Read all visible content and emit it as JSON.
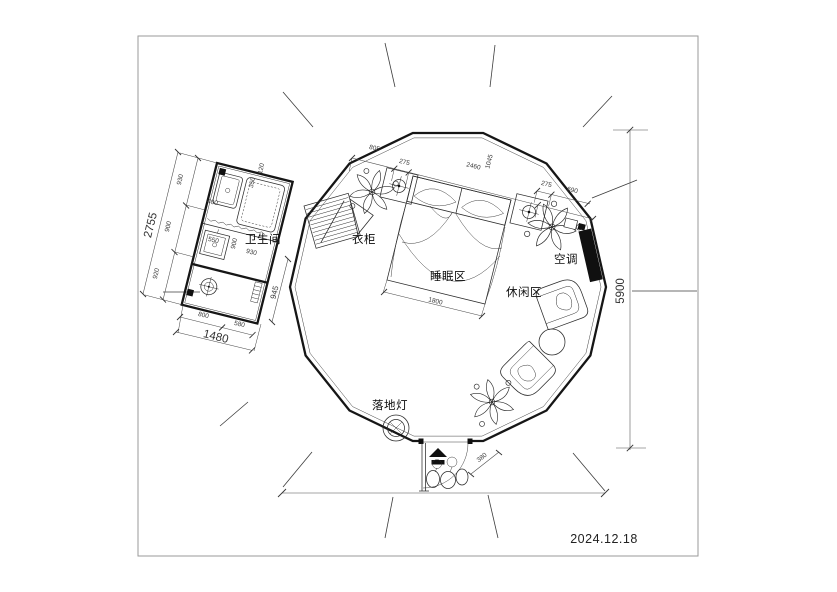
{
  "meta": {
    "date": "2024.12.18"
  },
  "colors": {
    "ink": "#2b2b2b",
    "wall": "#161616",
    "ac_fill": "#101010"
  },
  "rooms": {
    "bathroom": "卫生间",
    "wardrobe": "衣柜",
    "sleeping": "睡眠区",
    "leisure": "休闲区",
    "ac": "空调",
    "floor_lamp": "落地灯"
  },
  "dims": {
    "left_total": "2755",
    "left_seg": [
      "930",
      "900",
      "920"
    ],
    "bath_bottom_seg": [
      "800",
      "580"
    ],
    "bath_bottom_total": "1480",
    "bath_side": "945",
    "bath_inner": {
      "sink": "550",
      "w1": "900",
      "w2": "930",
      "tub": "400",
      "s1": "350",
      "s2": "120"
    },
    "top_seg": [
      "805",
      "275",
      "2460",
      "1045"
    ],
    "top_right_seg": [
      "275",
      "690"
    ],
    "bed_width": "1800",
    "height_total": "5900",
    "entrance": "380"
  },
  "icons": {
    "entry_arrow": "entry-direction-arrow",
    "lamp_cross": "table-lamp-symbol",
    "drain": "floor-drain-symbol"
  }
}
